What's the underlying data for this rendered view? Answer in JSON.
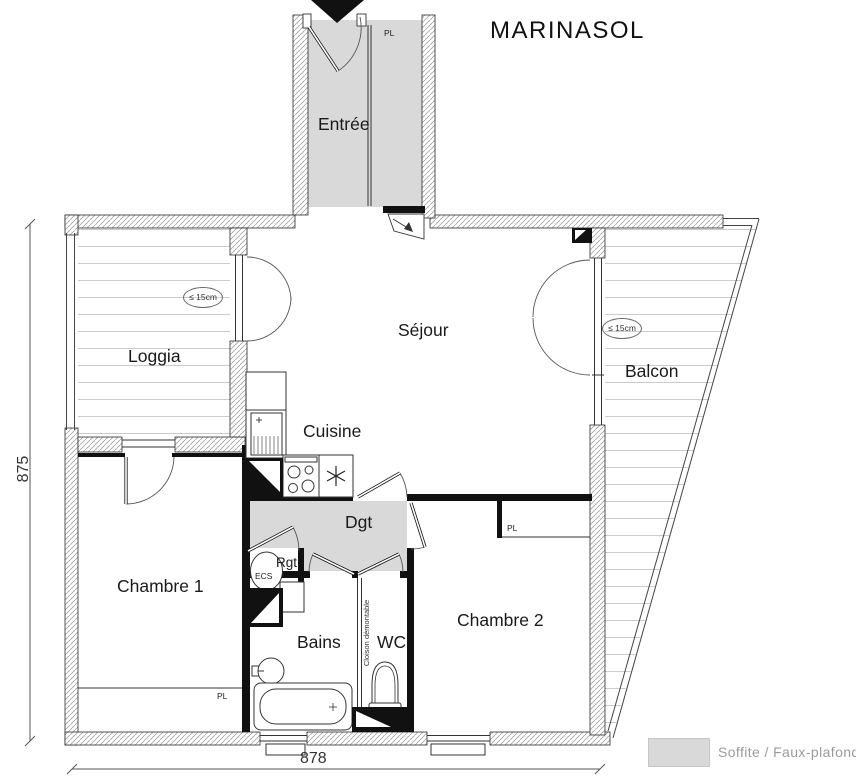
{
  "title": "MARINASOL",
  "rooms": {
    "entree": "Entrée",
    "sejour": "Séjour",
    "loggia": "Loggia",
    "balcon": "Balcon",
    "cuisine": "Cuisine",
    "dgt": "Dgt",
    "rgt": "Rgt",
    "chambre1": "Chambre 1",
    "chambre2": "Chambre 2",
    "bains": "Bains",
    "wc": "WC"
  },
  "annotations": {
    "pl_entree": "PL",
    "pl_chambre1": "PL",
    "pl_chambre2": "PL",
    "ecs": "ECS",
    "cloison_demontable": "Cloison démontable",
    "loggia_depth": "≤ 15cm",
    "balcon_depth": "≤ 15cm"
  },
  "dimensions": {
    "total_width_cm": "878",
    "total_height_cm": "875"
  },
  "legend": {
    "label": "Soffite / Faux-plafond",
    "swatch_color": "#d9d9d9"
  },
  "colors": {
    "faux_plafond": "#d9d9d9",
    "wall_hatch_line": "#a3a3a3",
    "outline": "#111111",
    "deck_line": "#cbcbcb",
    "legend_text": "#9b9b9b"
  }
}
